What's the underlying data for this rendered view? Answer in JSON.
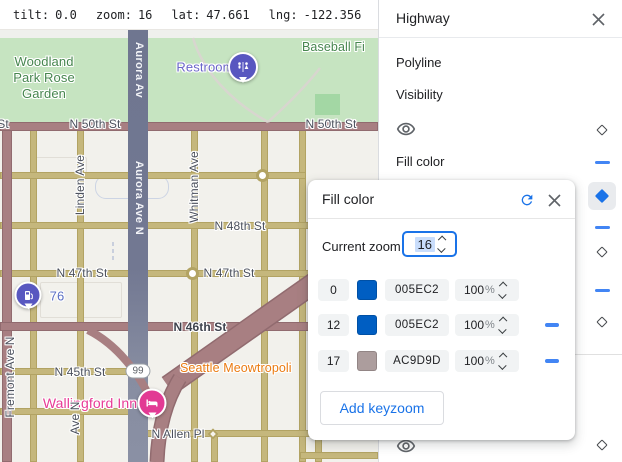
{
  "toolbar": {
    "tilt_label": "tilt:",
    "tilt_value": "0.0",
    "zoom_label": "zoom:",
    "zoom_value": "16",
    "lat_label": "lat:",
    "lat_value": "47.661",
    "lng_label": "lng:",
    "lng_value": "-122.356"
  },
  "panel": {
    "title": "Highway",
    "close_icon": "close-icon",
    "polyline_label": "Polyline",
    "visibility_label": "Visibility",
    "fill_color_label": "Fill color",
    "right_icons": [
      "diamond-outline",
      "dash",
      "diamond-filled-selected",
      "dash",
      "diamond-outline",
      "dash",
      "diamond-outline",
      "diamond-outline"
    ],
    "visibility_icon": "eye-icon"
  },
  "dialog": {
    "title": "Fill color",
    "reset_icon": "reset-icon",
    "close_icon": "close-icon",
    "current_zoom_label": "Current zoom",
    "current_zoom_value": "16",
    "rows": [
      {
        "zoom": "0",
        "hex": "005EC2",
        "swatch_color": "#005EC2",
        "opacity_value": "100",
        "opacity_unit": "%",
        "removable": false
      },
      {
        "zoom": "12",
        "hex": "005EC2",
        "swatch_color": "#005EC2",
        "opacity_value": "100",
        "opacity_unit": "%",
        "removable": true
      },
      {
        "zoom": "17",
        "hex": "AC9D9D",
        "swatch_color": "#AC9D9D",
        "opacity_value": "100",
        "opacity_unit": "%",
        "removable": true
      }
    ],
    "add_button_label": "Add keyzoom"
  },
  "map": {
    "labels": {
      "woodland": "Woodland\nPark Rose\nGarden",
      "baseball": "Baseball Fi",
      "restroom": "Restroom",
      "aurora_top": "Aurora Av",
      "aurora_mid": "Aurora Ave N",
      "st_partial": "St",
      "n50_left": "N 50th St",
      "n50_right": "N 50th St",
      "linden": "Linden Ave",
      "whitman": "Whitman Ave",
      "n48": "N 48th St",
      "n47_left": "N 47th St",
      "n47_right": "N 47th St",
      "gas76": "76",
      "n46": "N 46th St",
      "n45": "N 45th St",
      "route99": "99",
      "meowtropolitan": "Seattle Meowtropoli",
      "wallingford": "Wallingford Inn",
      "ave_n": "Ave N",
      "fremont": "Fremont Ave N",
      "allen": "N Allen Pl"
    },
    "pins": [
      "restroom-pin",
      "gas-station-pin",
      "hotel-pin"
    ]
  },
  "colors": {
    "accent_blue": "#1a73e8",
    "control_blue": "#4285f4",
    "keyzoom_blue": "#005EC2",
    "keyzoom_mauve": "#AC9D9D",
    "chip_gray": "#f1f3f4",
    "highway_road": "#a87f82",
    "minor_road": "#c5b77c",
    "aurora_road": "#6f7690",
    "park_green": "#c6e4c1",
    "park_label_green": "#47864f",
    "poi_indigo": "#5857c0",
    "hotel_pink": "#e23a94",
    "poi_orange": "#ea7b12"
  }
}
